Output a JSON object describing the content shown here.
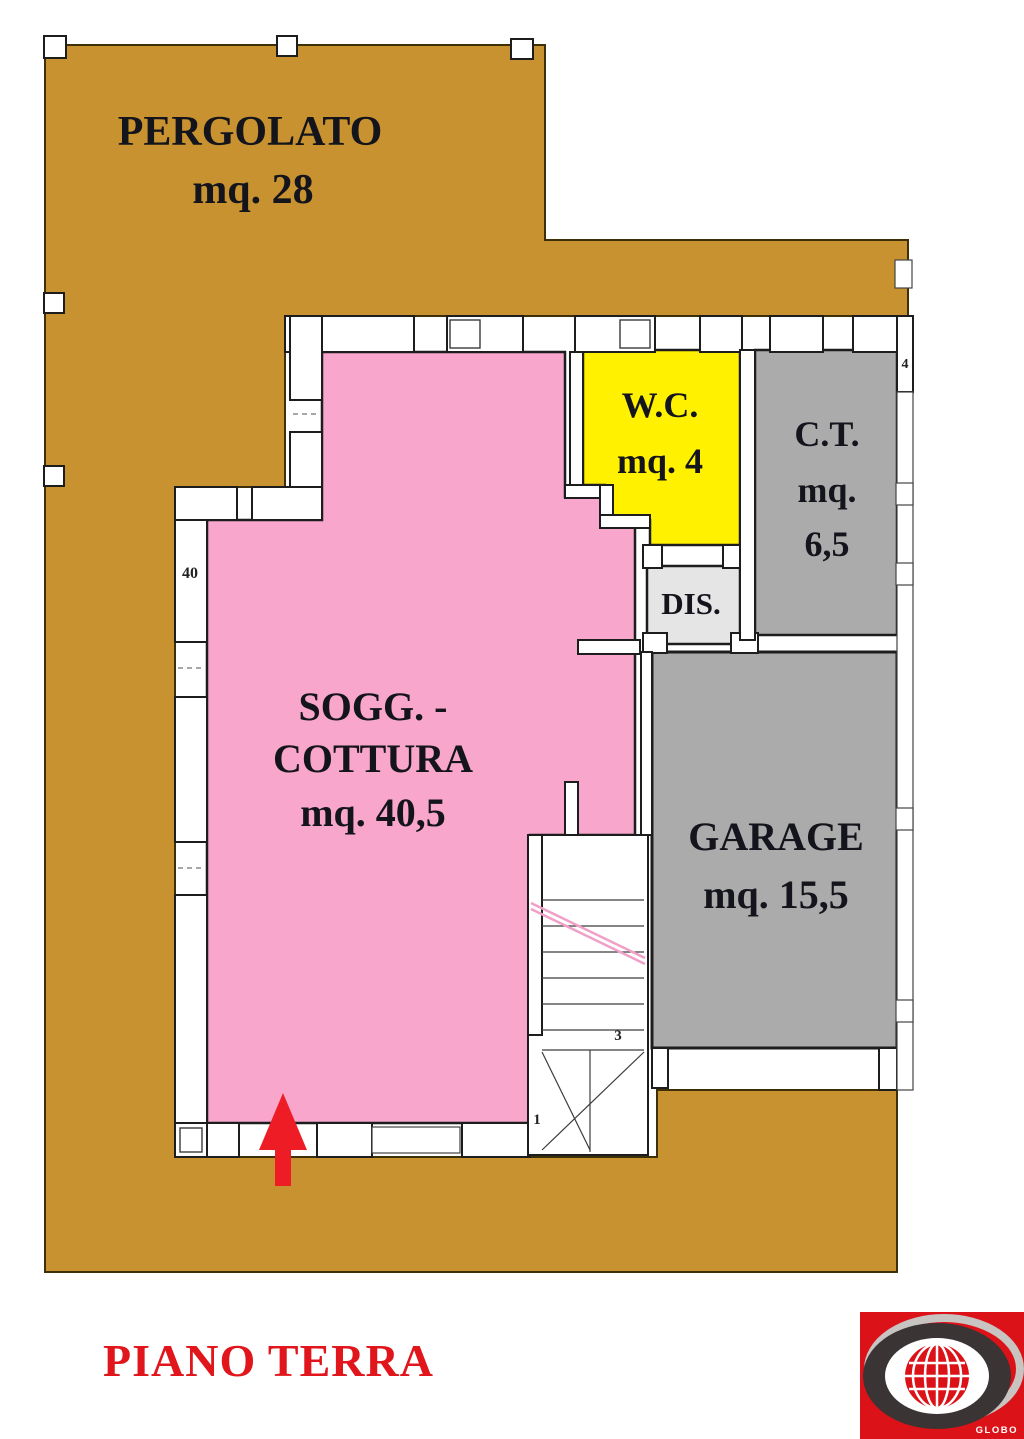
{
  "plan": {
    "title": "PIANO TERRA",
    "rooms": {
      "pergolato": {
        "lines": [
          "PERGOLATO",
          "mq. 28"
        ],
        "color": "#c7922f"
      },
      "soggiorno": {
        "lines": [
          "SOGG. -",
          "COTTURA",
          "mq. 40,5"
        ],
        "color": "#f8a6cb"
      },
      "wc": {
        "lines": [
          "W.C.",
          "mq. 4"
        ],
        "color": "#fff100"
      },
      "ct": {
        "lines": [
          "C.T.",
          "mq.",
          "6,5"
        ],
        "color": "#ababab"
      },
      "dis": {
        "lines": [
          "DIS."
        ],
        "color": "#e5e5e5"
      },
      "garage": {
        "lines": [
          "GARAGE",
          "mq. 15,5"
        ],
        "color": "#ababab"
      }
    },
    "annotations": {
      "wall_dim_40": "40",
      "window_dim_4": "4",
      "stair_step_1": "1",
      "stair_step_3": "3"
    },
    "colors": {
      "wall": "#1d1d1d",
      "terrace_edge": "#3d2f07",
      "label_text": "#14141c",
      "arrow": "#ee1c24",
      "title": "#e0161c",
      "handrail": "#f0a0c8"
    },
    "logo": {
      "brand": "GLOBO",
      "bg": "#dc1219",
      "ring": "#3a3435",
      "swoosh": "#c8c4c2",
      "globe": "#dc1219",
      "grid": "#ffffff",
      "text_color": "#ffffff"
    }
  }
}
